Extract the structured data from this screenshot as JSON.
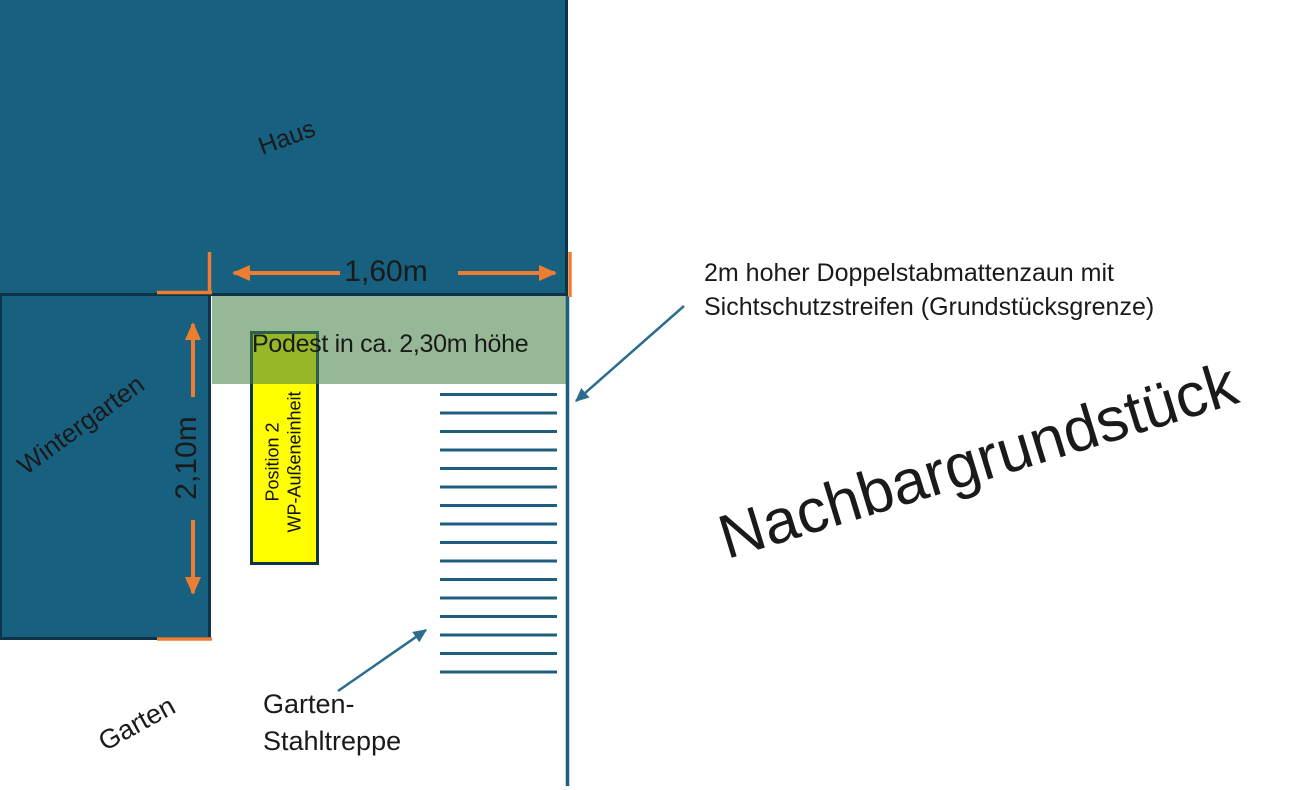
{
  "canvas": {
    "width": 1289,
    "height": 790
  },
  "colors": {
    "building_fill": "#176080",
    "building_border": "#0f3347",
    "podest_band": "rgba(70,130,70,0.57)",
    "wp_fill": "#ffff00",
    "dimension_accent": "#ED7D31",
    "line_teal": "#1f5e80",
    "arrow_teal": "#2b6c8f",
    "text": "#1a1a1a"
  },
  "areas": {
    "haus": {
      "label": "Haus"
    },
    "wintergarten": {
      "label": "Wintergarten"
    },
    "garten": {
      "label": "Garten"
    },
    "nachbargrundstueck": {
      "label": "Nachbargrundstück"
    },
    "podest": {
      "label": "Podest in ca. 2,30m höhe"
    },
    "wp_unit": {
      "label_line1": "Position 2",
      "label_line2": "WP-Außeneinheit"
    }
  },
  "dimensions": {
    "width": {
      "label": "1,60m"
    },
    "height": {
      "label": "2,10m"
    }
  },
  "annotations": {
    "fence": {
      "label_line1": "2m hoher Doppelstabmattenzaun mit",
      "label_line2": "Sichtschutzstreifen (Grundstücksgrenze)"
    },
    "stairs": {
      "label_line1": "Garten-",
      "label_line2": "Stahltreppe",
      "step_count": 16
    }
  }
}
